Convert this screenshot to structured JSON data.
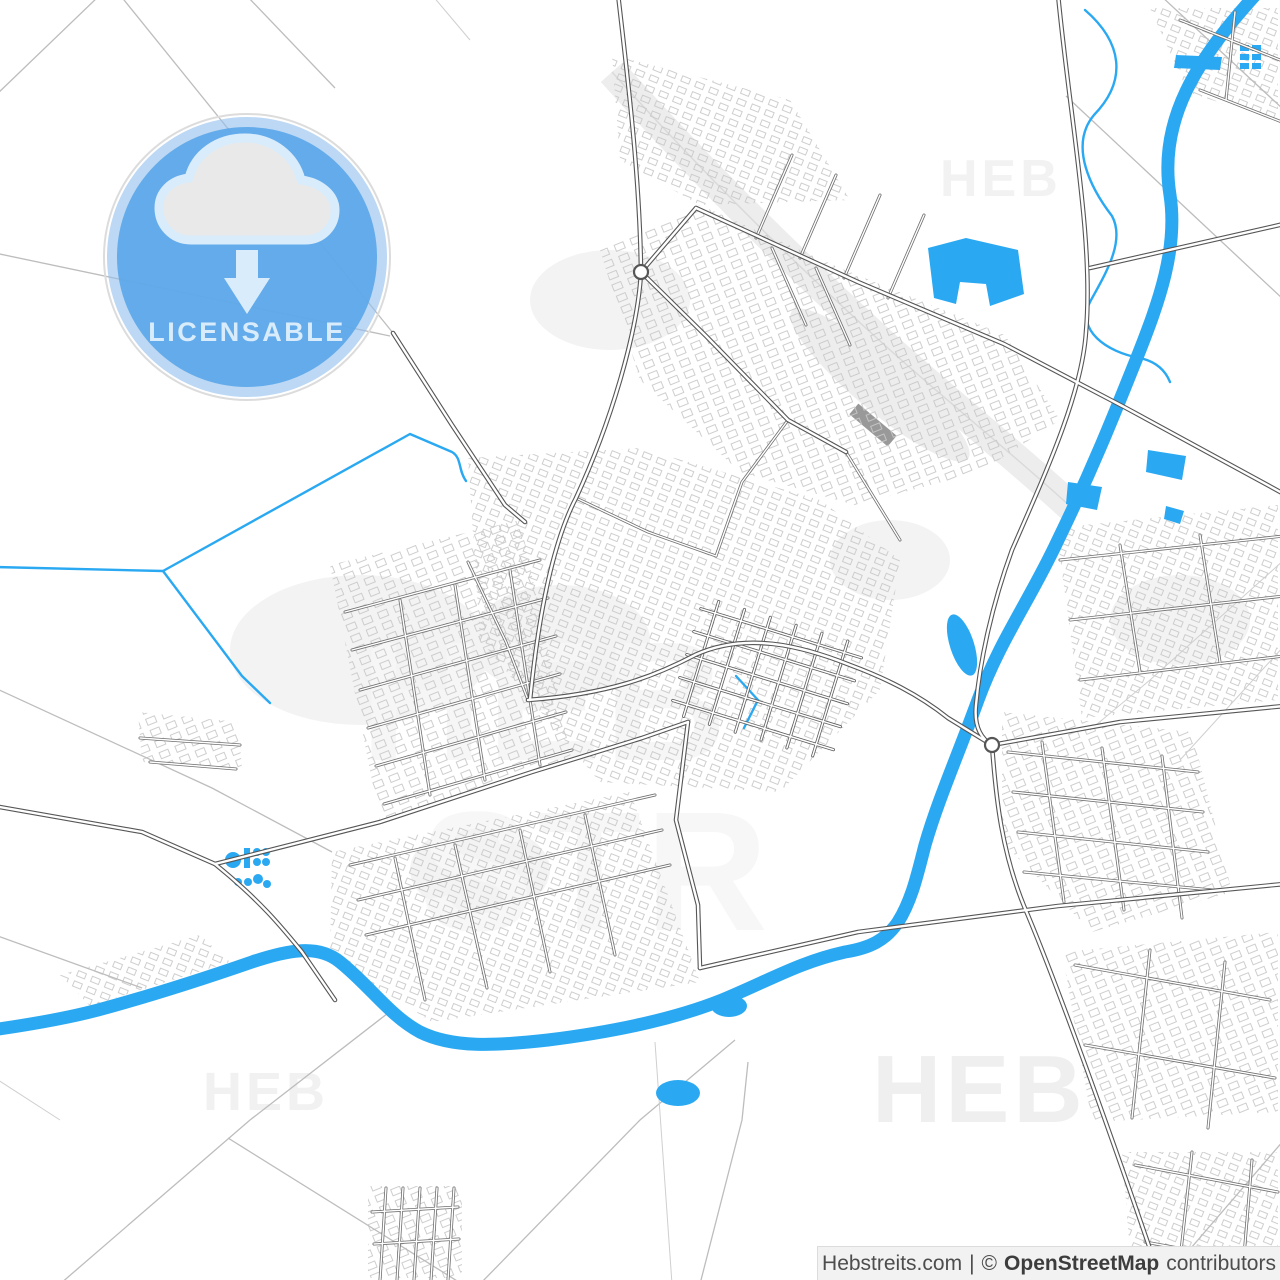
{
  "badge": {
    "label": "LICENSABLE",
    "icon": "cloud-download-icon",
    "circle_color": "#5BA7E8",
    "ring_color": "#8FBEEC",
    "edge_color": "#DCDCDC",
    "icon_cloud_fill": "#E9E9E9",
    "icon_accent_color": "#D9ECFB"
  },
  "watermarks": {
    "text": "HEB",
    "center_secondary": "STR",
    "color": "#F0F0F0"
  },
  "attribution": {
    "site": "Hebstreits.com",
    "separator": "|",
    "copyright_symbol": "©",
    "source_name": "OpenStreetMap",
    "contributors_label": "contributors"
  },
  "map": {
    "description": "vector-city-street-map",
    "background_color": "#FFFFFF",
    "water_color": "#2AA9F2",
    "road_casing_color": "#565656",
    "road_fill_color": "#FFFFFF",
    "minor_road_color": "#6F6F6F",
    "rural_road_color": "#BDBDBD",
    "building_outline_color": "#C9C9C9",
    "railway_color": "#EDEDED",
    "park_color": "#F3F3F3"
  }
}
